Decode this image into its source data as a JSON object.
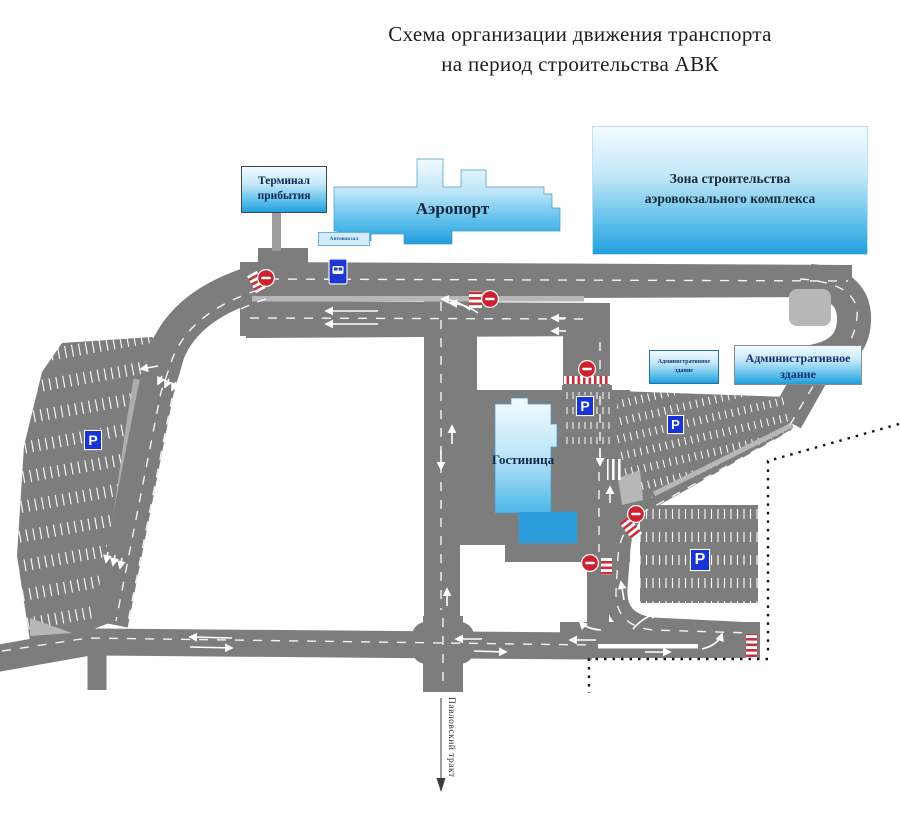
{
  "title": {
    "line1": "Схема организации движения транспорта",
    "line2": "на период строительства АВК"
  },
  "buildings": {
    "terminal_sign": "Терминал прибытия",
    "airport": "Аэропорт",
    "construction_zone": "Зона строительства аэровокзального комплекса",
    "hotel": "Гостиница",
    "admin_building_small": "Административное здание",
    "admin_building_label": "Административное здание"
  },
  "labels": {
    "bus_station": "Автовокзал",
    "road_name": "Павловский тракт",
    "parking_letter": "P"
  },
  "legend_colors": {
    "road": "#7d7d7d",
    "road_light": "#b7b7b7",
    "building_blue_top": "#eef8fe",
    "building_blue_bottom": "#28a4e0",
    "parking_sign_blue": "#1634d8",
    "no_entry_red": "#cf2030",
    "crosswalk_red": "#c7303a",
    "boundary_black": "#141414"
  }
}
